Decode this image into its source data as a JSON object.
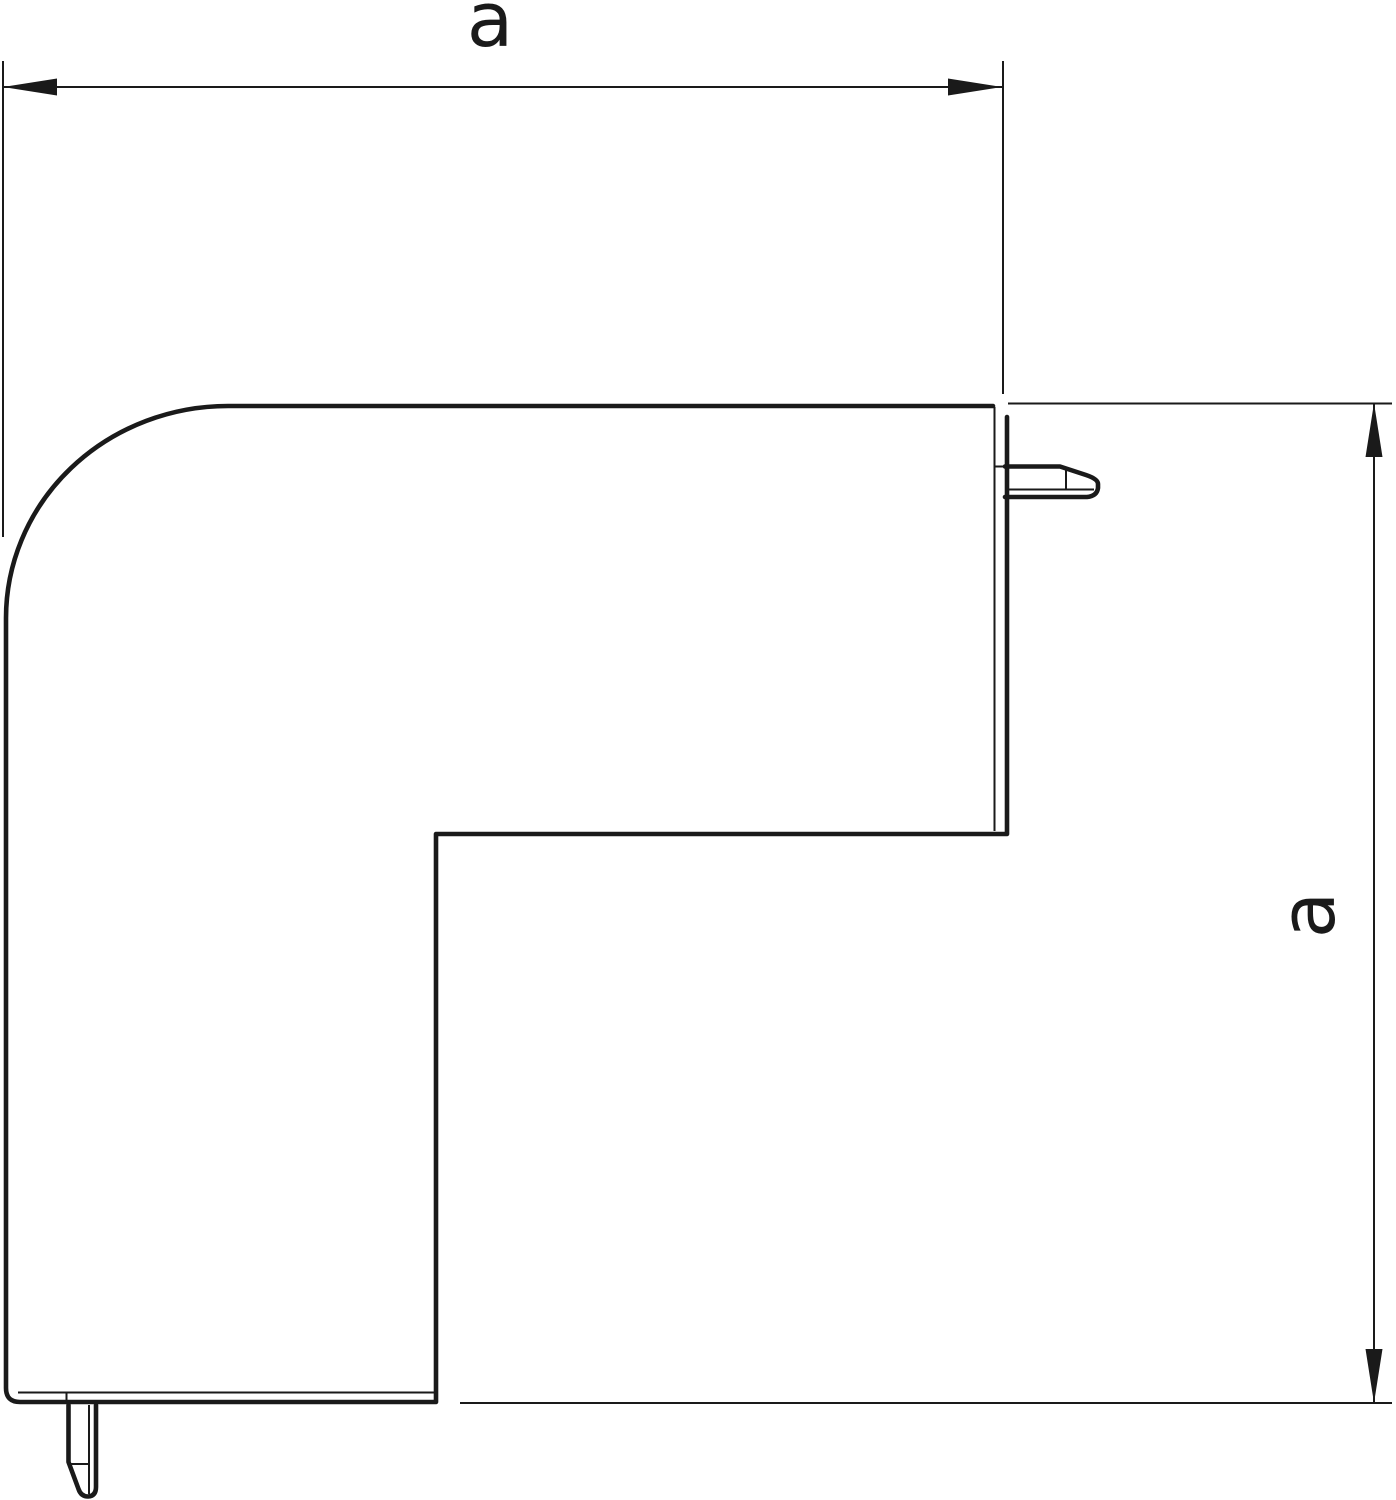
{
  "page": {
    "background": "#ffffff"
  },
  "drawing": {
    "ink": "#1a1a1a",
    "kind": "technical-dimension-drawing",
    "part": "corner-profile-with-snap-lugs",
    "dimensions": {
      "horizontal": {
        "label": "a",
        "orientation": "horizontal",
        "position": "top"
      },
      "vertical": {
        "label": "a",
        "orientation": "vertical",
        "position": "right"
      }
    }
  }
}
